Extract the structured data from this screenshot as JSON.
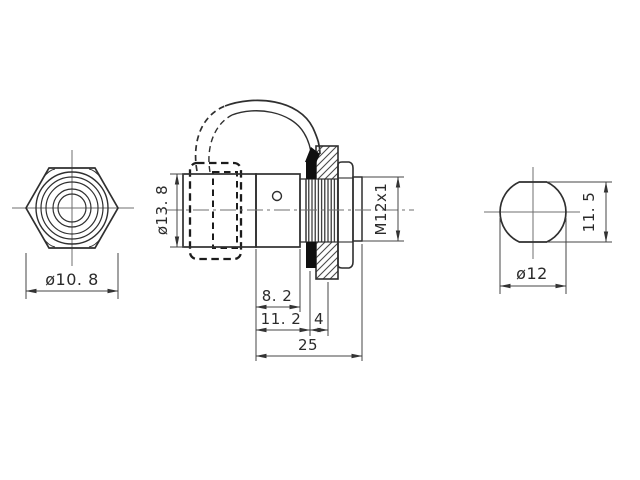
{
  "drawing": {
    "type": "technical-orthographic-drawing",
    "background_color": "#ffffff",
    "line_color": "#2f2f2f",
    "dimension_line_color": "#444444",
    "centerline_color": "#6f6f6f",
    "seal_fill_color": "#101010",
    "views": {
      "front": {
        "description": "hex coupling nut front view",
        "dim_diameter": "ø10. 8"
      },
      "side": {
        "description": "side profile with dashed protective cap, lanyard strap, hatched mounting flange, threaded section, hex nut and thread stub",
        "dim_cap_diameter": "ø13. 8",
        "dim_thread": "M12x1",
        "dim_front_length": "8. 2",
        "dim_to_flange": "11. 2",
        "dim_flange_thickness": "4",
        "dim_total_length": "25"
      },
      "end": {
        "description": "rear end view, circle with two flats",
        "dim_diameter": "ø12",
        "dim_across_flats": "11. 5"
      }
    },
    "dimensions_mm": {
      "front_hex_diameter": 10.8,
      "cap_diameter": 13.8,
      "thread_spec": "M12x1",
      "front_section_length": 8.2,
      "length_to_flange": 11.2,
      "flange_thickness": 4,
      "total_length": 25,
      "end_diameter": 12,
      "end_across_flats": 11.5
    }
  }
}
